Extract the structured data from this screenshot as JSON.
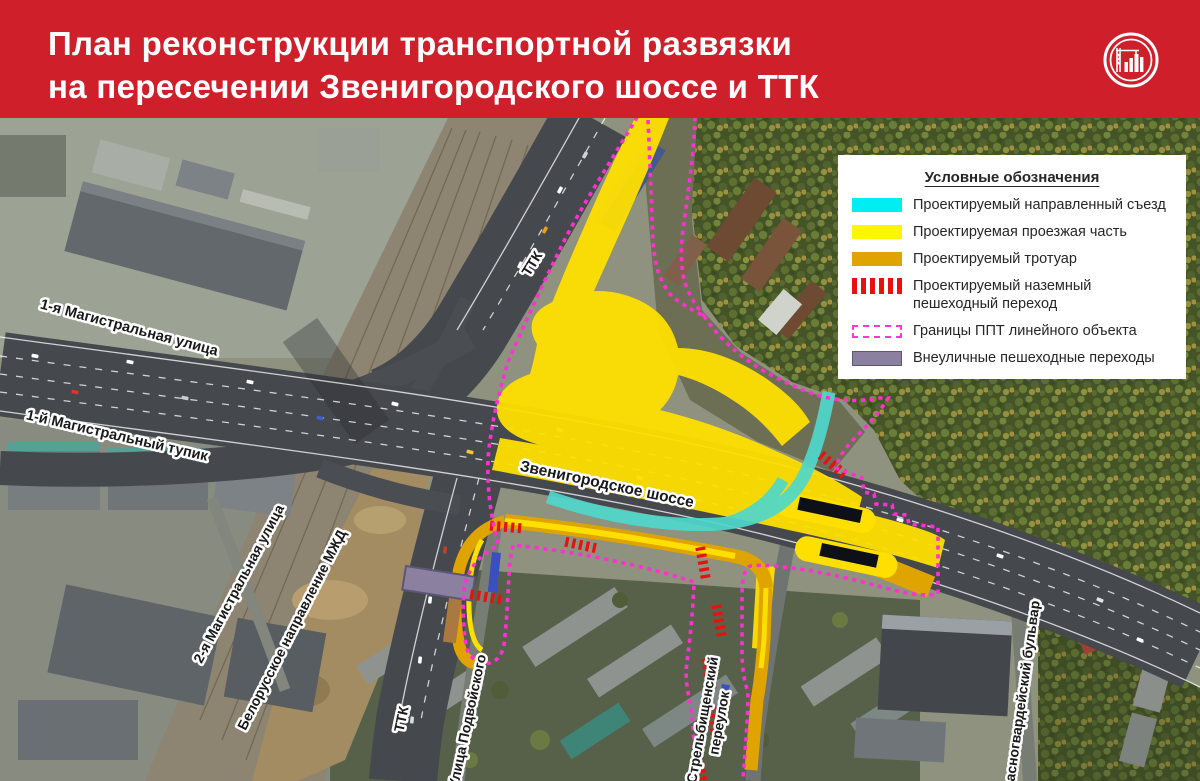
{
  "header": {
    "title_line1": "План реконструкции транспортной развязки",
    "title_line2": "на пересечении Звенигородского шоссе и ТТК"
  },
  "legend": {
    "title": "Условные обозначения",
    "items": [
      {
        "label": "Проектируемый направленный съезд",
        "type": "cyan"
      },
      {
        "label": "Проектируемая проезжая часть",
        "type": "yellow"
      },
      {
        "label": "Проектируемый тротуар",
        "type": "orange"
      },
      {
        "label": "Проектируемый наземный пешеходный переход",
        "type": "red-hatch"
      },
      {
        "label": "Границы ППТ линейного объекта",
        "type": "dashed-outline"
      },
      {
        "label": "Внеуличные пешеходные переходы",
        "type": "purple"
      }
    ]
  },
  "map": {
    "labels": {
      "magistralnaya1": "1-я Магистральная улица",
      "tupik1": "1-й Магистральный тупик",
      "magistralnaya2": "2-я Магистральная улица",
      "mzd": "Белорусское направление МЖД",
      "ttk_north": "ТТК",
      "zvenigorodskoe": "Звенигородское шоссе",
      "ttk_south": "ТТК",
      "podvoyskogo": "Улица Подвойского",
      "strelbishchensky_line1": "Стрельбищенский",
      "strelbishchensky_line2": "переулок",
      "krasnogvardeysky": "Красногвардейский бульвар"
    }
  },
  "colors": {
    "header_bg": "#ce1f2a",
    "proposed_ramp_cyan": "#00eef2",
    "proposed_road_yellow": "#ffdf00",
    "proposed_sidewalk_orange": "#e0a400",
    "crosswalk_red": "#e81111",
    "ppt_boundary_magenta": "#ff35d5",
    "underpass_purple": "#8b809f"
  }
}
